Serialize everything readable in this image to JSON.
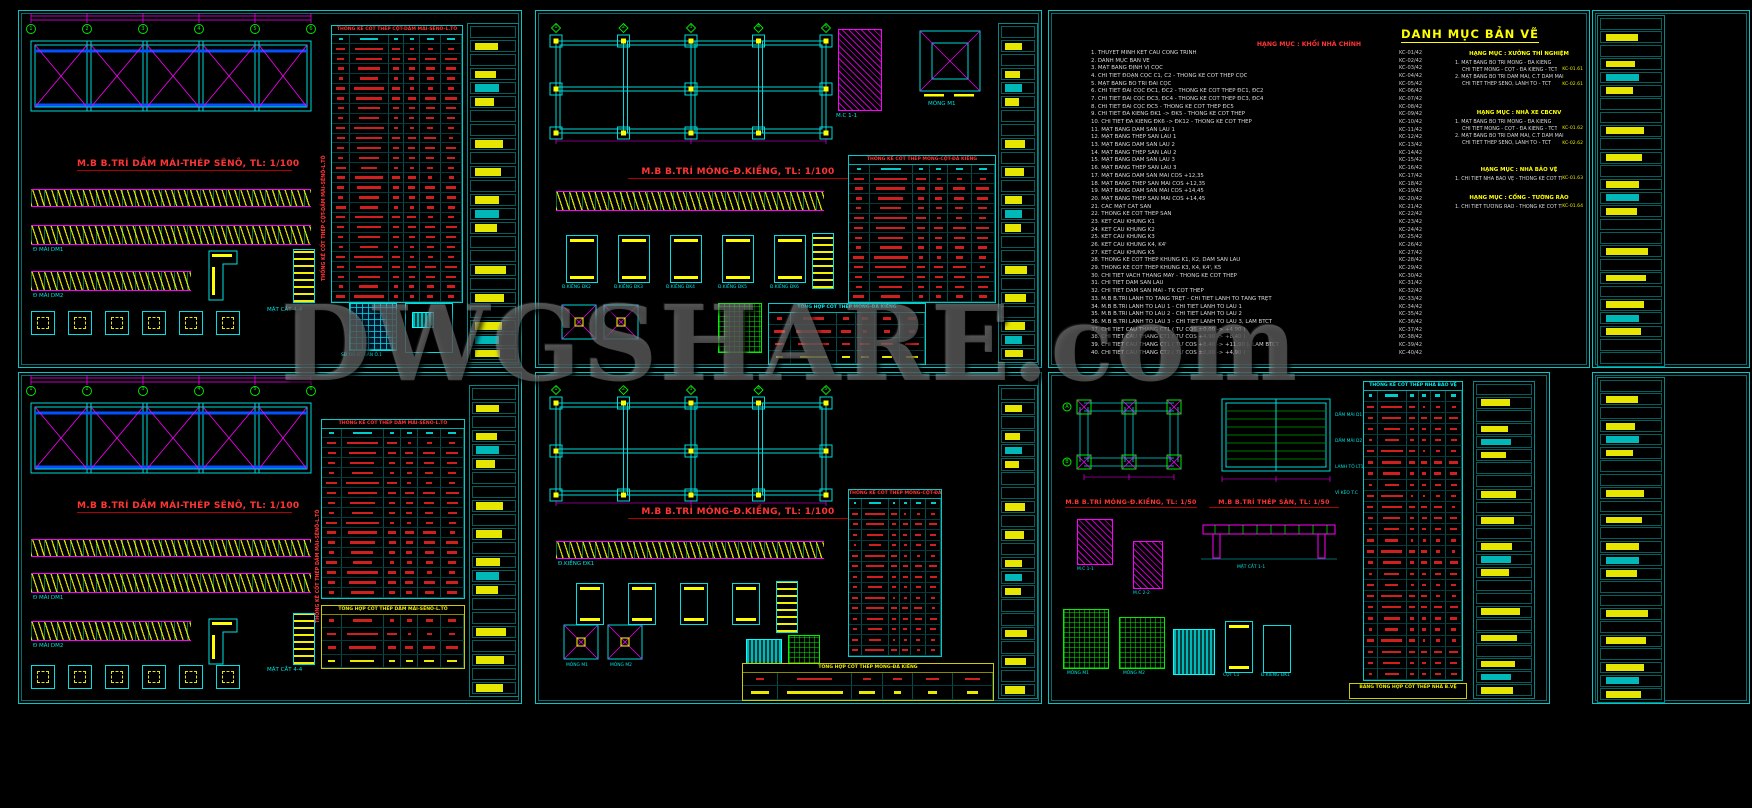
{
  "watermark": "DWGSHARE.com",
  "colors": {
    "background": "#000000",
    "line_cyan": "#00e0e0",
    "line_magenta": "#ff00ff",
    "accent_yellow": "#ffff00",
    "title_red": "#ff3434",
    "line_green": "#00ee00",
    "line_blue": "#0550ff",
    "watermark_gray": "#919191"
  },
  "sheet1": {
    "plan_title": "M.B B.TRÍ DẦM MÁI-THÉP SÊNÔ, TL: 1/100",
    "schedule_title": "THỐNG KÊ CỐT THÉP CỘT-DẦM MÁI-SÊNÔ-L.TÔ",
    "axes": [
      "1",
      "2",
      "3",
      "4",
      "5",
      "6"
    ],
    "labels": {
      "beam1": "Đ MÁI DM1",
      "beam2": "Đ MÁI DM2",
      "section": "MẶT CẮT 4-4",
      "slab": "SĐ ĐỔ BT SÀN Ô.1"
    }
  },
  "sheet2": {
    "plan_title": "M.B B.TRÍ MÓNG-Đ.KIỀNG, TL: 1/100",
    "schedule_title": "THỐNG KÊ CỐT THÉP MÓNG-CỘT-ĐÀ KIỀNG",
    "summary_title": "TỔNG HỢP CỐT THÉP MÓNG-ĐÀ KIỀNG",
    "axes": [
      "1",
      "2",
      "3",
      "4",
      "5"
    ],
    "labels": {
      "section": "M.C 1-1",
      "footing": "MÓNG M1",
      "dk": [
        "Đ.KIỀNG ĐK2",
        "Đ.KIỀNG ĐK3",
        "Đ.KIỀNG ĐK4",
        "Đ.KIỀNG ĐK5",
        "Đ.KIỀNG ĐK6"
      ]
    }
  },
  "sheet3": {
    "title": "DANH MỤC BẢN VẼ",
    "main_header": "HẠNG MỤC : KHỐI NHÀ CHÍNH",
    "items": [
      {
        "t": "1. THUYẾT MINH KẾT CẤU CÔNG TRÌNH",
        "c": "KC-01/42"
      },
      {
        "t": "2. DANH MỤC BẢN VẼ",
        "c": "KC-02/42"
      },
      {
        "t": "3. MẶT BẰNG ĐỊNH VỊ CỌC",
        "c": "KC-03/42"
      },
      {
        "t": "4. CHI TIẾT ĐOẠN CỌC C1, C2 - THỐNG KÊ CỐT THÉP CỌC",
        "c": "KC-04/42"
      },
      {
        "t": "5. MẶT BẰNG BỐ TRÍ ĐÀI CỌC",
        "c": "KC-05/42"
      },
      {
        "t": "6. CHI TIẾT ĐÀI CỌC ĐC1, ĐC2 - THỐNG KÊ CỐT THÉP ĐC1, ĐC2",
        "c": "KC-06/42"
      },
      {
        "t": "7. CHI TIẾT ĐÀI CỌC ĐC3, ĐC4 - THỐNG KÊ CỐT THÉP ĐC3, ĐC4",
        "c": "KC-07/42"
      },
      {
        "t": "8. CHI TIẾT ĐÀI CỌC ĐC5 - THỐNG KÊ CỐT THÉP ĐC5",
        "c": "KC-08/42"
      },
      {
        "t": "9. CHI TIẾT ĐÀ KIỀNG ĐK1 -> ĐK5 - THỐNG KÊ CỐT THÉP",
        "c": "KC-09/42"
      },
      {
        "t": "10. CHI TIẾT ĐÀ KIỀNG ĐK6 -> ĐK12 - THỐNG KÊ CỐT THÉP",
        "c": "KC-10/42"
      },
      {
        "t": "11. MẶT BẰNG DẦM SÀN LẦU 1",
        "c": "KC-11/42"
      },
      {
        "t": "12. MẶT BẰNG THÉP SÀN LẦU 1",
        "c": "KC-12/42"
      },
      {
        "t": "13. MẶT BẰNG DẦM SÀN LẦU 2",
        "c": "KC-13/42"
      },
      {
        "t": "14. MẶT BẰNG THÉP SÀN LẦU 2",
        "c": "KC-14/42"
      },
      {
        "t": "15. MẶT BẰNG DẦM SÀN LẦU 3",
        "c": "KC-15/42"
      },
      {
        "t": "16. MẶT BẰNG THÉP SÀN LẦU 3",
        "c": "KC-16/42"
      },
      {
        "t": "17. MẶT BẰNG DẦM SÀN MÁI CỐS +12,35",
        "c": "KC-17/42"
      },
      {
        "t": "18. MẶT BẰNG THÉP SÀN MÁI CỐS +12,35",
        "c": "KC-18/42"
      },
      {
        "t": "19. MẶT BẰNG DẦM SÀN MÁI CỐS +14,45",
        "c": "KC-19/42"
      },
      {
        "t": "20. MẶT BẰNG THÉP SÀN MÁI CỐS +14,45",
        "c": "KC-20/42"
      },
      {
        "t": "21. CÁC MẶT CẮT SÀN",
        "c": "KC-21/42"
      },
      {
        "t": "22. THỐNG KÊ CỐT THÉP SÀN",
        "c": "KC-22/42"
      },
      {
        "t": "23. KẾT CẤU KHUNG K1",
        "c": "KC-23/42"
      },
      {
        "t": "24. KẾT CẤU KHUNG K2",
        "c": "KC-24/42"
      },
      {
        "t": "25. KẾT CẤU KHUNG K3",
        "c": "KC-25/42"
      },
      {
        "t": "26. KẾT CẤU KHUNG K4, K4'",
        "c": "KC-26/42"
      },
      {
        "t": "27. KẾT CẤU KHUNG K5",
        "c": "KC-27/42"
      },
      {
        "t": "28. THỐNG KÊ CỐT THÉP KHUNG K1, K2, DẦM SÀN LẦU",
        "c": "KC-28/42"
      },
      {
        "t": "29. THỐNG KÊ CỐT THÉP KHUNG K3, K4, K4', K5",
        "c": "KC-29/42"
      },
      {
        "t": "30. CHI TIẾT VÁCH THANG MÁY - THỐNG KÊ CỐT THÉP",
        "c": "KC-30/42"
      },
      {
        "t": "31. CHI TIẾT DẦM SÀN LẦU",
        "c": "KC-31/42"
      },
      {
        "t": "32. CHI TIẾT DẦM SÀN MÁI - TK CỐT THÉP",
        "c": "KC-32/42"
      },
      {
        "t": "33. M.B B.TRÍ LANH TÔ TẦNG TRỆT - CHI TIẾT LANH TÔ TẦNG TRỆT",
        "c": "KC-33/42"
      },
      {
        "t": "34. M.B B.TRÍ LANH TÔ LẦU 1 - CHI TIẾT LANH TÔ LẦU 1",
        "c": "KC-34/42"
      },
      {
        "t": "35. M.B B.TRÍ LANH TÔ LẦU 2 - CHI TIẾT LANH TÔ LẦU 2",
        "c": "KC-35/42"
      },
      {
        "t": "36. M.B B.TRÍ LANH TÔ LẦU 3 - CHI TIẾT LANH TÔ LẦU 3, LAM BTCT",
        "c": "KC-36/42"
      },
      {
        "t": "37. CHI TIẾT CẦU THANG CT1 ( TỪ CỐS ±0,00 -> +4,90 )",
        "c": "KC-37/42"
      },
      {
        "t": "38. CHI TIẾT CẦU THANG CT1 ( TỪ CỐS +4,90 -> +8,40 )",
        "c": "KC-38/42"
      },
      {
        "t": "39. CHI TIẾT CẦU THANG CT1 ( TỪ CỐS +8,40 -> +11,90 ), LAM BTCT",
        "c": "KC-39/42"
      },
      {
        "t": "40. CHI TIẾT CẦU THANG CT2 ( TỪ CỐS ±0,00 -> +4,90 )",
        "c": "KC-40/42"
      }
    ],
    "sections": [
      {
        "h": "HẠNG MỤC : XƯỞNG THÍ NGHIỆM",
        "lines": [
          {
            "t": "1. MẶT BẰNG BỐ TRÍ MÓNG - ĐÀ KIỀNG",
            "c": ""
          },
          {
            "t": "CHI TIẾT MÓNG - CỘT - ĐÀ KIỀNG - TCT",
            "c": "KC-01.61"
          },
          {
            "t": "2. MẶT BẰNG BỐ TRÍ DẦM MÁI, C.T DẦM MÁI",
            "c": ""
          },
          {
            "t": "CHI TIẾT THÉP SÊNÔ, LANH TÔ - TCT",
            "c": "KC-02.61"
          }
        ]
      },
      {
        "h": "HẠNG MỤC : NHÀ XE CBCNV",
        "lines": [
          {
            "t": "1. MẶT BẰNG BỐ TRÍ MÓNG - ĐÀ KIỀNG",
            "c": ""
          },
          {
            "t": "CHI TIẾT MÓNG - CỘT - ĐÀ KIỀNG - TCT",
            "c": "KC-01.62"
          },
          {
            "t": "2. MẶT BẰNG BỐ TRÍ DẦM MÁI, C.T DẦM MÁI",
            "c": ""
          },
          {
            "t": "CHI TIẾT THÉP SÊNÔ, LANH TÔ - TCT",
            "c": "KC-02.62"
          }
        ]
      },
      {
        "h": "HẠNG MỤC : NHÀ BẢO VỆ",
        "lines": [
          {
            "t": "1. CHI TIẾT NHÀ BẢO VỆ - THỐNG KÊ CỐT THÉP",
            "c": "KC-01.63"
          }
        ]
      },
      {
        "h": "HẠNG MỤC : CỔNG - TƯỜNG RÀO",
        "lines": [
          {
            "t": "1. CHI TIẾT TƯỜNG RÀO - THỐNG KÊ CỐT THÉP",
            "c": "KC-01.64"
          }
        ]
      }
    ]
  },
  "sheet4": {
    "plan_title": "M.B B.TRÍ DẦM MÁI-THÉP SÊNÔ, TL: 1/100",
    "schedule_title": "THỐNG KÊ CỐT THÉP DẦM MÁI-SÊNÔ-L.TÔ",
    "summary_title": "TỔNG HỢP CỐT THÉP DẦM MÁI-SÊNÔ-L.TÔ",
    "axes": [
      "1",
      "2",
      "3",
      "4",
      "5",
      "6"
    ],
    "labels": {
      "beam1": "Đ MÁI DM1",
      "beam2": "Đ MÁI DM2",
      "section": "MẶT CẮT 4-4"
    }
  },
  "sheet5": {
    "plan_title": "M.B B.TRÍ MÓNG-Đ.KIỀNG, TL: 1/100",
    "schedule_title": "THỐNG KÊ CỐT THÉP MÓNG-CỘT-ĐÀ KIỀNG",
    "summary_title": "TỔNG HỢP CỐT THÉP MÓNG-ĐÀ KIỀNG",
    "axes": [
      "1",
      "2",
      "3",
      "4",
      "5"
    ],
    "labels": {
      "dk1": "Đ.KIỀNG ĐK1",
      "mong1": "MÓNG M1",
      "mong2": "MÓNG M2",
      "cot": "CỘT C1"
    }
  },
  "sheet6": {
    "plan1_title": "M.B B.TRÍ MÓNG-Đ.KIỀNG, TL: 1/50",
    "plan2_title": "M.B B.TRÍ THÉP SÀN, TL: 1/50",
    "schedule_title": "THỐNG KÊ CỐT THÉP NHÀ BẢO VỆ",
    "summary_title": "BẢNG TỔNG HỢP CỐT THÉP NHÀ B.VỆ",
    "axes": [
      "A",
      "B"
    ],
    "labels": {
      "dam1": "DẦM MÁI D1",
      "dam2": "DẦM MÁI D2",
      "lanhto": "LANH TÔ LT1",
      "vikeo": "VỈ KÈO T.C",
      "matcat": "MẶT CẮT 1-1",
      "mc1": "M.C 1-1",
      "mc2": "M.C 2-2",
      "mong1": "MÓNG M1",
      "mong2": "MÓNG M2",
      "cot": "CỘT C1",
      "dk": "Đ.KIỀNG ĐK1"
    }
  }
}
